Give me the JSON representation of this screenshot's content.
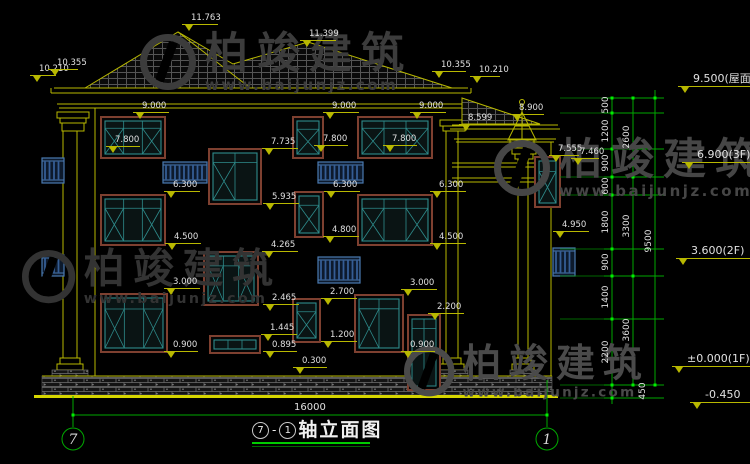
{
  "drawing": {
    "title": {
      "axis_start": "7",
      "dash": "-",
      "axis_end": "1",
      "name": "轴立面图"
    },
    "axis_bubbles": {
      "left": "7",
      "right": "1"
    },
    "bottom_dimension": {
      "value": "16000"
    },
    "right_dimension_stack": {
      "labels": [
        {
          "v": "500",
          "x": 606,
          "y": 105,
          "col": "inner"
        },
        {
          "v": "1200",
          "x": 606,
          "y": 131,
          "col": "inner"
        },
        {
          "v": "900",
          "x": 606,
          "y": 163,
          "col": "inner"
        },
        {
          "v": "600",
          "x": 606,
          "y": 186,
          "col": "inner"
        },
        {
          "v": "1800",
          "x": 606,
          "y": 222,
          "col": "inner"
        },
        {
          "v": "900",
          "x": 606,
          "y": 262,
          "col": "inner"
        },
        {
          "v": "1400",
          "x": 606,
          "y": 297,
          "col": "inner"
        },
        {
          "v": "2200",
          "x": 606,
          "y": 352,
          "col": "inner"
        },
        {
          "v": "450",
          "x": 643,
          "y": 391,
          "col": "inner"
        },
        {
          "v": "2600",
          "x": 627,
          "y": 137,
          "col": "group"
        },
        {
          "v": "3300",
          "x": 627,
          "y": 226,
          "col": "group"
        },
        {
          "v": "3600",
          "x": 627,
          "y": 330,
          "col": "group"
        },
        {
          "v": "9500",
          "x": 649,
          "y": 241,
          "col": "overall"
        }
      ]
    },
    "elevation_markers": [
      {
        "v": "11.763",
        "x": 182,
        "y": 14,
        "w": 36
      },
      {
        "v": "11.399",
        "x": 300,
        "y": 30,
        "w": 36
      },
      {
        "v": "10.210",
        "x": 30,
        "y": 65,
        "w": 26
      },
      {
        "v": "10.355",
        "x": 48,
        "y": 59,
        "w": 30
      },
      {
        "v": "10.355",
        "x": 432,
        "y": 61,
        "w": 34
      },
      {
        "v": "10.210",
        "x": 470,
        "y": 66,
        "w": 30
      },
      {
        "v": "9.000",
        "x": 133,
        "y": 102,
        "w": 36
      },
      {
        "v": "9.000",
        "x": 323,
        "y": 102,
        "w": 36
      },
      {
        "v": "9.000",
        "x": 410,
        "y": 102,
        "w": 36
      },
      {
        "v": "8.900",
        "x": 510,
        "y": 104,
        "w": 34
      },
      {
        "v": "8.599",
        "x": 459,
        "y": 114,
        "w": 36
      },
      {
        "v": "7.800",
        "x": 106,
        "y": 136,
        "w": 34
      },
      {
        "v": "7.800",
        "x": 314,
        "y": 135,
        "w": 34
      },
      {
        "v": "7.800",
        "x": 383,
        "y": 135,
        "w": 34
      },
      {
        "v": "7.735",
        "x": 262,
        "y": 138,
        "w": 36
      },
      {
        "v": "7.555",
        "x": 549,
        "y": 145,
        "w": 30
      },
      {
        "v": "7.460",
        "x": 571,
        "y": 148,
        "w": 28
      },
      {
        "v": "6.300",
        "x": 164,
        "y": 181,
        "w": 36
      },
      {
        "v": "6.300",
        "x": 324,
        "y": 181,
        "w": 36
      },
      {
        "v": "6.300",
        "x": 430,
        "y": 181,
        "w": 36
      },
      {
        "v": "5.935",
        "x": 263,
        "y": 193,
        "w": 36
      },
      {
        "v": "4.950",
        "x": 553,
        "y": 221,
        "w": 36
      },
      {
        "v": "4.800",
        "x": 323,
        "y": 226,
        "w": 36
      },
      {
        "v": "4.500",
        "x": 165,
        "y": 233,
        "w": 36
      },
      {
        "v": "4.500",
        "x": 430,
        "y": 233,
        "w": 36
      },
      {
        "v": "4.265",
        "x": 262,
        "y": 241,
        "w": 36
      },
      {
        "v": "3.000",
        "x": 164,
        "y": 278,
        "w": 36
      },
      {
        "v": "3.000",
        "x": 401,
        "y": 279,
        "w": 36
      },
      {
        "v": "2.700",
        "x": 321,
        "y": 288,
        "w": 36
      },
      {
        "v": "2.465",
        "x": 263,
        "y": 294,
        "w": 36
      },
      {
        "v": "2.200",
        "x": 428,
        "y": 303,
        "w": 36
      },
      {
        "v": "1.445",
        "x": 261,
        "y": 324,
        "w": 36
      },
      {
        "v": "1.200",
        "x": 321,
        "y": 331,
        "w": 36
      },
      {
        "v": "0.900",
        "x": 164,
        "y": 341,
        "w": 34
      },
      {
        "v": "0.900",
        "x": 401,
        "y": 341,
        "w": 34
      },
      {
        "v": "0.895",
        "x": 263,
        "y": 341,
        "w": 34
      },
      {
        "v": "0.300",
        "x": 293,
        "y": 357,
        "w": 34
      },
      {
        "v": "9.500(屋面)",
        "x": 678,
        "y": 73,
        "w": 86,
        "big": true
      },
      {
        "v": "6.900(3F)",
        "x": 682,
        "y": 149,
        "w": 80,
        "big": true
      },
      {
        "v": "3.600(2F)",
        "x": 676,
        "y": 245,
        "w": 80,
        "big": true
      },
      {
        "v": "±0.000(1F)",
        "x": 672,
        "y": 353,
        "w": 80,
        "big": true
      },
      {
        "v": "-0.450",
        "x": 690,
        "y": 389,
        "w": 70,
        "big": true
      }
    ],
    "watermarks": [
      {
        "text": "柏竣建筑",
        "url": "www.baijunjz.com",
        "x": 140,
        "y": 34,
        "scale": 1,
        "color": "#3c3c3c"
      },
      {
        "text": "柏竣建筑",
        "url": "www.baijunjz.com",
        "x": 494,
        "y": 140,
        "scale": 1,
        "color": "#464646"
      },
      {
        "text": "柏竣建筑",
        "url": "www.baijunjz.com",
        "x": 22,
        "y": 250,
        "scale": 0.95,
        "color": "#333333"
      },
      {
        "text": "柏竣建筑",
        "url": "www.baijunjz.com",
        "x": 404,
        "y": 346,
        "scale": 0.9,
        "color": "#4a4a4a"
      }
    ],
    "colors": {
      "background": "#000000",
      "line_yellow": "#b8b800",
      "ground_yellow": "#d6d600",
      "dimension_green": "#00a800",
      "grip_green": "#00ee00",
      "text_white": "#e0e0e0",
      "window_teal": "#2e8b8b",
      "window_trim_brown": "#7e4030",
      "railing_blue": "#4a7ab0",
      "title_underline_green": "#00cc00"
    }
  }
}
